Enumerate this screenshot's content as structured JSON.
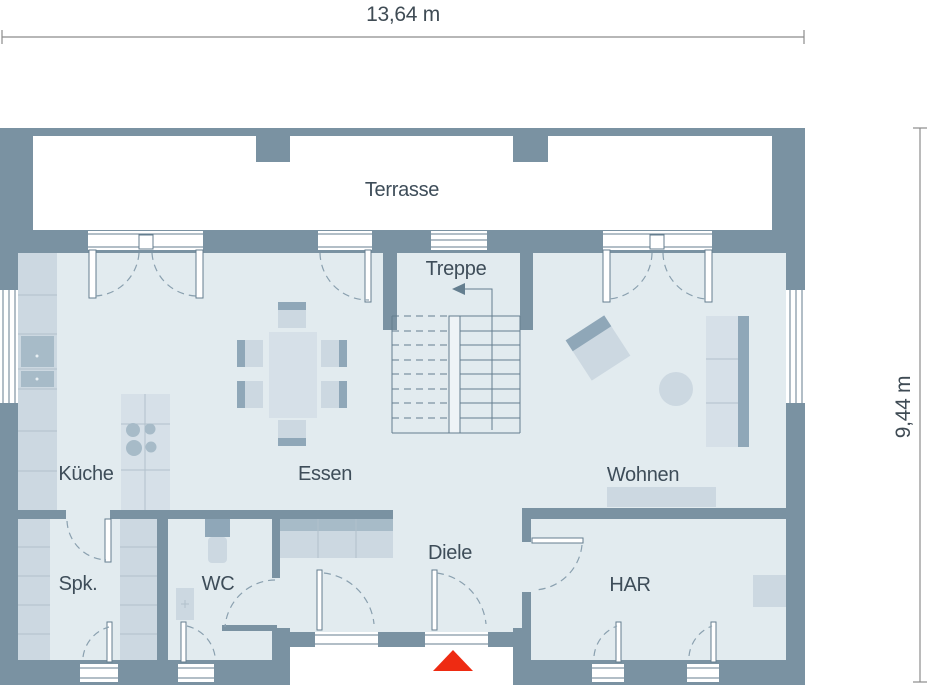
{
  "dims": {
    "width": "13,64 m",
    "height": "9,44 m"
  },
  "rooms": {
    "terrasse": {
      "label": "Terrasse"
    },
    "treppe": {
      "label": "Treppe"
    },
    "kueche": {
      "label": "Küche"
    },
    "essen": {
      "label": "Essen"
    },
    "wohnen": {
      "label": "Wohnen"
    },
    "spk": {
      "label": "Spk."
    },
    "wc": {
      "label": "WC"
    },
    "diele": {
      "label": "Diele"
    },
    "har": {
      "label": "HAR"
    }
  },
  "markers": {
    "entrance_icon": "red-triangle-up",
    "stair_direction_icon": "arrow-left"
  },
  "colors": {
    "wall": "#7a92a2",
    "floor": "#e2ebef",
    "terrace": "#ffffff",
    "furniture": "#ccd8e1",
    "furniture_dark": "#8fa7b8",
    "entrance_marker": "#ee2b12",
    "label_text": "#3e4d59",
    "dimension_line": "#8c8c8c"
  }
}
